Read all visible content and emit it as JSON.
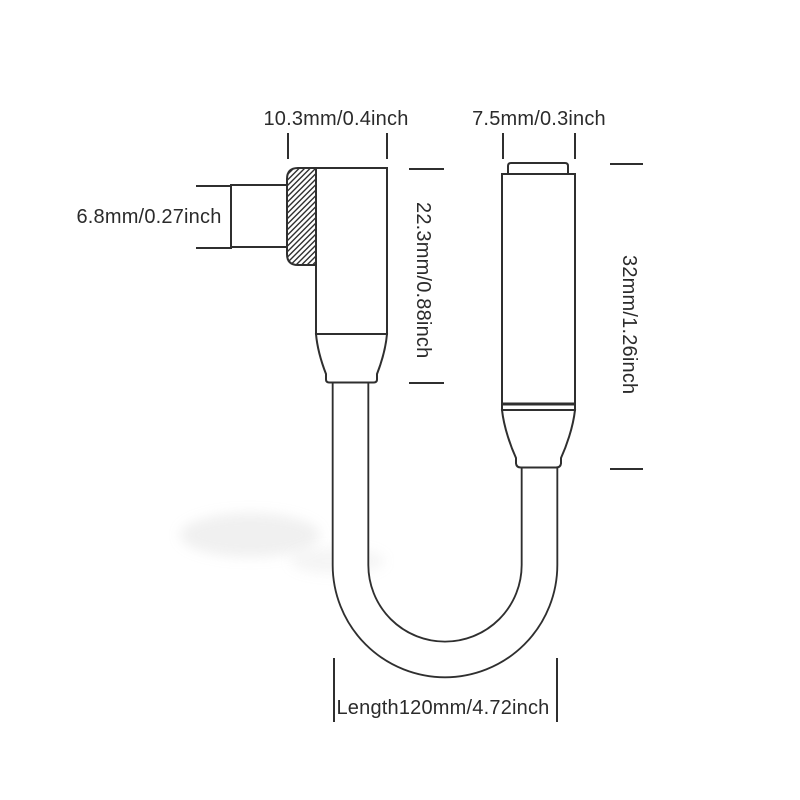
{
  "diagram": {
    "kind": "product-dimension-diagram",
    "labels": {
      "usbc_width": "10.3mm/0.4inch",
      "jack_width": "7.5mm/0.3inch",
      "usbc_plug_height": "6.8mm/0.27inch",
      "usbc_body_length": "22.3mm/0.88inch",
      "jack_body_length": "32mm/1.26inch",
      "cable_length": "Length120mm/4.72inch"
    },
    "colors": {
      "line": "#2f2f2f",
      "text": "#2b2b2b",
      "background": "#ffffff"
    }
  }
}
